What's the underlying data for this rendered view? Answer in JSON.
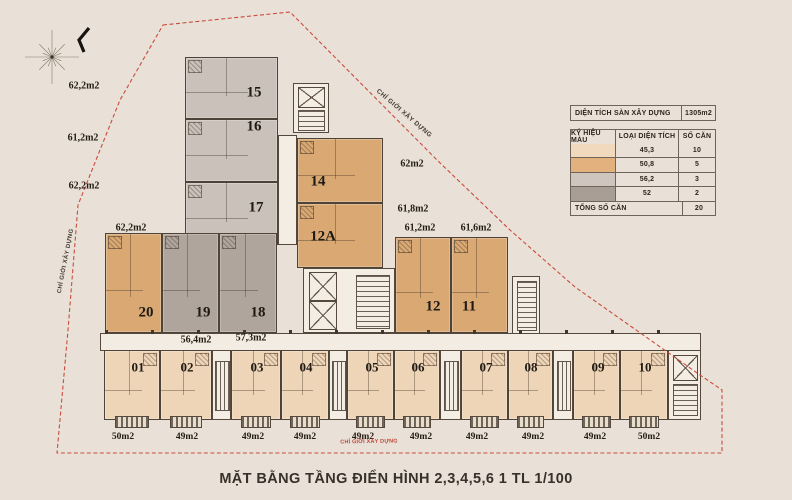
{
  "page": {
    "title": "MẶT BẰNG TẦNG ĐIỂN HÌNH 2,3,4,5,6 1 TL 1/100",
    "background_color": "#e9e1d7"
  },
  "boundary": {
    "label": "CHỈ GIỚI XÂY DỰNG",
    "line_color": "#c94c3c"
  },
  "legend": {
    "area_label": "DIỆN TÍCH SÀN XÂY DỰNG",
    "area_value": "1305m2",
    "columns": [
      "KÝ HIỆU MÀU",
      "LOẠI DIỆN TÍCH",
      "SỐ CĂN"
    ],
    "rows": [
      {
        "color": "#f1d9bd",
        "area": "45,3",
        "count": "10"
      },
      {
        "color": "#e3b17d",
        "area": "50,8",
        "count": "5"
      },
      {
        "color": "#cdc5be",
        "area": "56,2",
        "count": "3"
      },
      {
        "color": "#a89e95",
        "area": "52",
        "count": "2"
      }
    ],
    "total_label": "TỔNG SỐ CĂN",
    "total_value": "20"
  },
  "units": [
    {
      "number": "01",
      "area": "50m2",
      "type": "peach"
    },
    {
      "number": "02",
      "area": "49m2",
      "type": "peach"
    },
    {
      "number": "03",
      "area": "49m2",
      "type": "peach"
    },
    {
      "number": "04",
      "area": "49m2",
      "type": "peach"
    },
    {
      "number": "05",
      "area": "49m2",
      "type": "peach"
    },
    {
      "number": "06",
      "area": "49m2",
      "type": "peach"
    },
    {
      "number": "07",
      "area": "49m2",
      "type": "peach"
    },
    {
      "number": "08",
      "area": "49m2",
      "type": "peach"
    },
    {
      "number": "09",
      "area": "49m2",
      "type": "peach"
    },
    {
      "number": "10",
      "area": "50m2",
      "type": "peach"
    },
    {
      "number": "11",
      "area": "61,6m2",
      "type": "tan"
    },
    {
      "number": "12",
      "area": "61,2m2",
      "type": "tan"
    },
    {
      "number": "12A",
      "area": "61,8m2",
      "type": "tan"
    },
    {
      "number": "14",
      "area": "62m2",
      "type": "tan"
    },
    {
      "number": "15",
      "area": "62,2m2",
      "type": "gray"
    },
    {
      "number": "16",
      "area": "61,2m2",
      "type": "gray"
    },
    {
      "number": "17",
      "area": "62,2m2",
      "type": "gray"
    },
    {
      "number": "18",
      "area": "57,3m2",
      "type": "darkgray"
    },
    {
      "number": "19",
      "area": "56,4m2",
      "type": "darkgray"
    },
    {
      "number": "20",
      "area": "62,2m2",
      "type": "tan"
    }
  ]
}
